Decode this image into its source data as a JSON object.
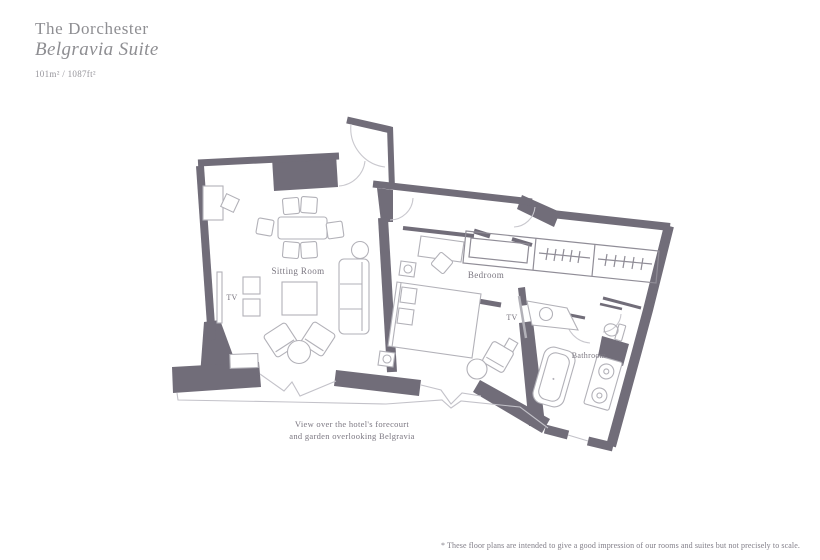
{
  "header": {
    "hotel_name": "The Dorchester",
    "suite_name": "Belgravia Suite",
    "area": "101m² / 1087ft²"
  },
  "floorplan": {
    "rooms": [
      {
        "label": "Sitting Room"
      },
      {
        "label": "Bedroom"
      },
      {
        "label": "Bathroom"
      }
    ],
    "tv_labels": [
      "TV",
      "TV"
    ],
    "view_note": {
      "line1": "View over the hotel's forecourt",
      "line2": "and garden overlooking Belgravia"
    }
  },
  "footer": {
    "disclaimer": "* These floor plans are intended to give a good impression of our rooms and suites but not precisely to scale."
  },
  "colors": {
    "wall": "#716d79",
    "furniture_line": "#b2b1b8",
    "door_arc": "#c9c8ce",
    "label_text": "#7b7781",
    "title_text": "#8e8e92"
  }
}
